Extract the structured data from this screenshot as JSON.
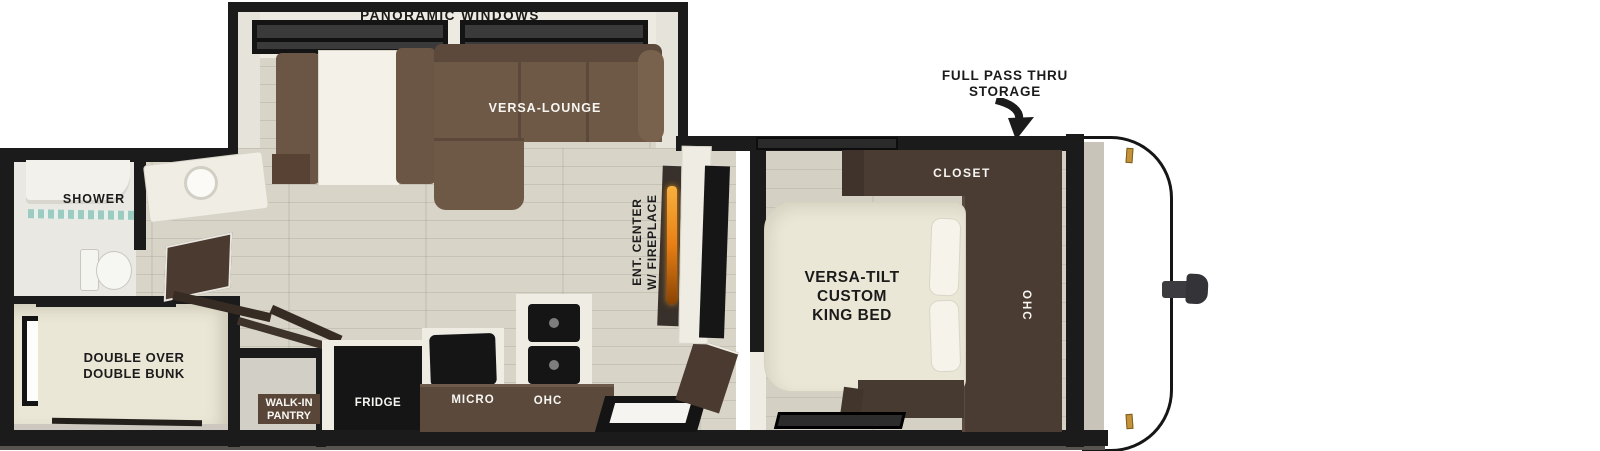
{
  "slide_out": {
    "panoramic_label": "PANORAMIC WINDOWS",
    "lounge_label": "VERSA-LOUNGE"
  },
  "front_storage": {
    "lines": [
      "FULL PASS THRU",
      "STORAGE"
    ]
  },
  "bathroom": {
    "shower_label": "SHOWER"
  },
  "bunk_room": {
    "lines": [
      "DOUBLE OVER",
      "DOUBLE BUNK"
    ]
  },
  "pantry": {
    "lines": [
      "WALK-IN",
      "PANTRY"
    ]
  },
  "kitchen": {
    "fridge_label": "FRIDGE",
    "micro_label": "MICRO",
    "ohc_label": "OHC"
  },
  "ent_center": {
    "lines": [
      "ENT. CENTER",
      "W/ FIREPLACE"
    ]
  },
  "bedroom": {
    "closet_label": "CLOSET",
    "ohc_label": "OHC",
    "bed_lines": [
      "VERSA-TILT",
      "CUSTOM",
      "KING BED"
    ]
  },
  "colors": {
    "wall_black": "#1b1b1b",
    "floor_plank": "#d8d4c8",
    "sofa_brown": "#6e5947",
    "cabinet_dark_wood": "#4a3c33",
    "bed_cream": "#ebe7d7",
    "flame_orange": "#f59a23",
    "pantry_badge_brown": "#5a4639",
    "marker_light_gold": "#c49339",
    "shower_glass_teal": "#8fc7bb",
    "appliance_black": "#151515"
  }
}
